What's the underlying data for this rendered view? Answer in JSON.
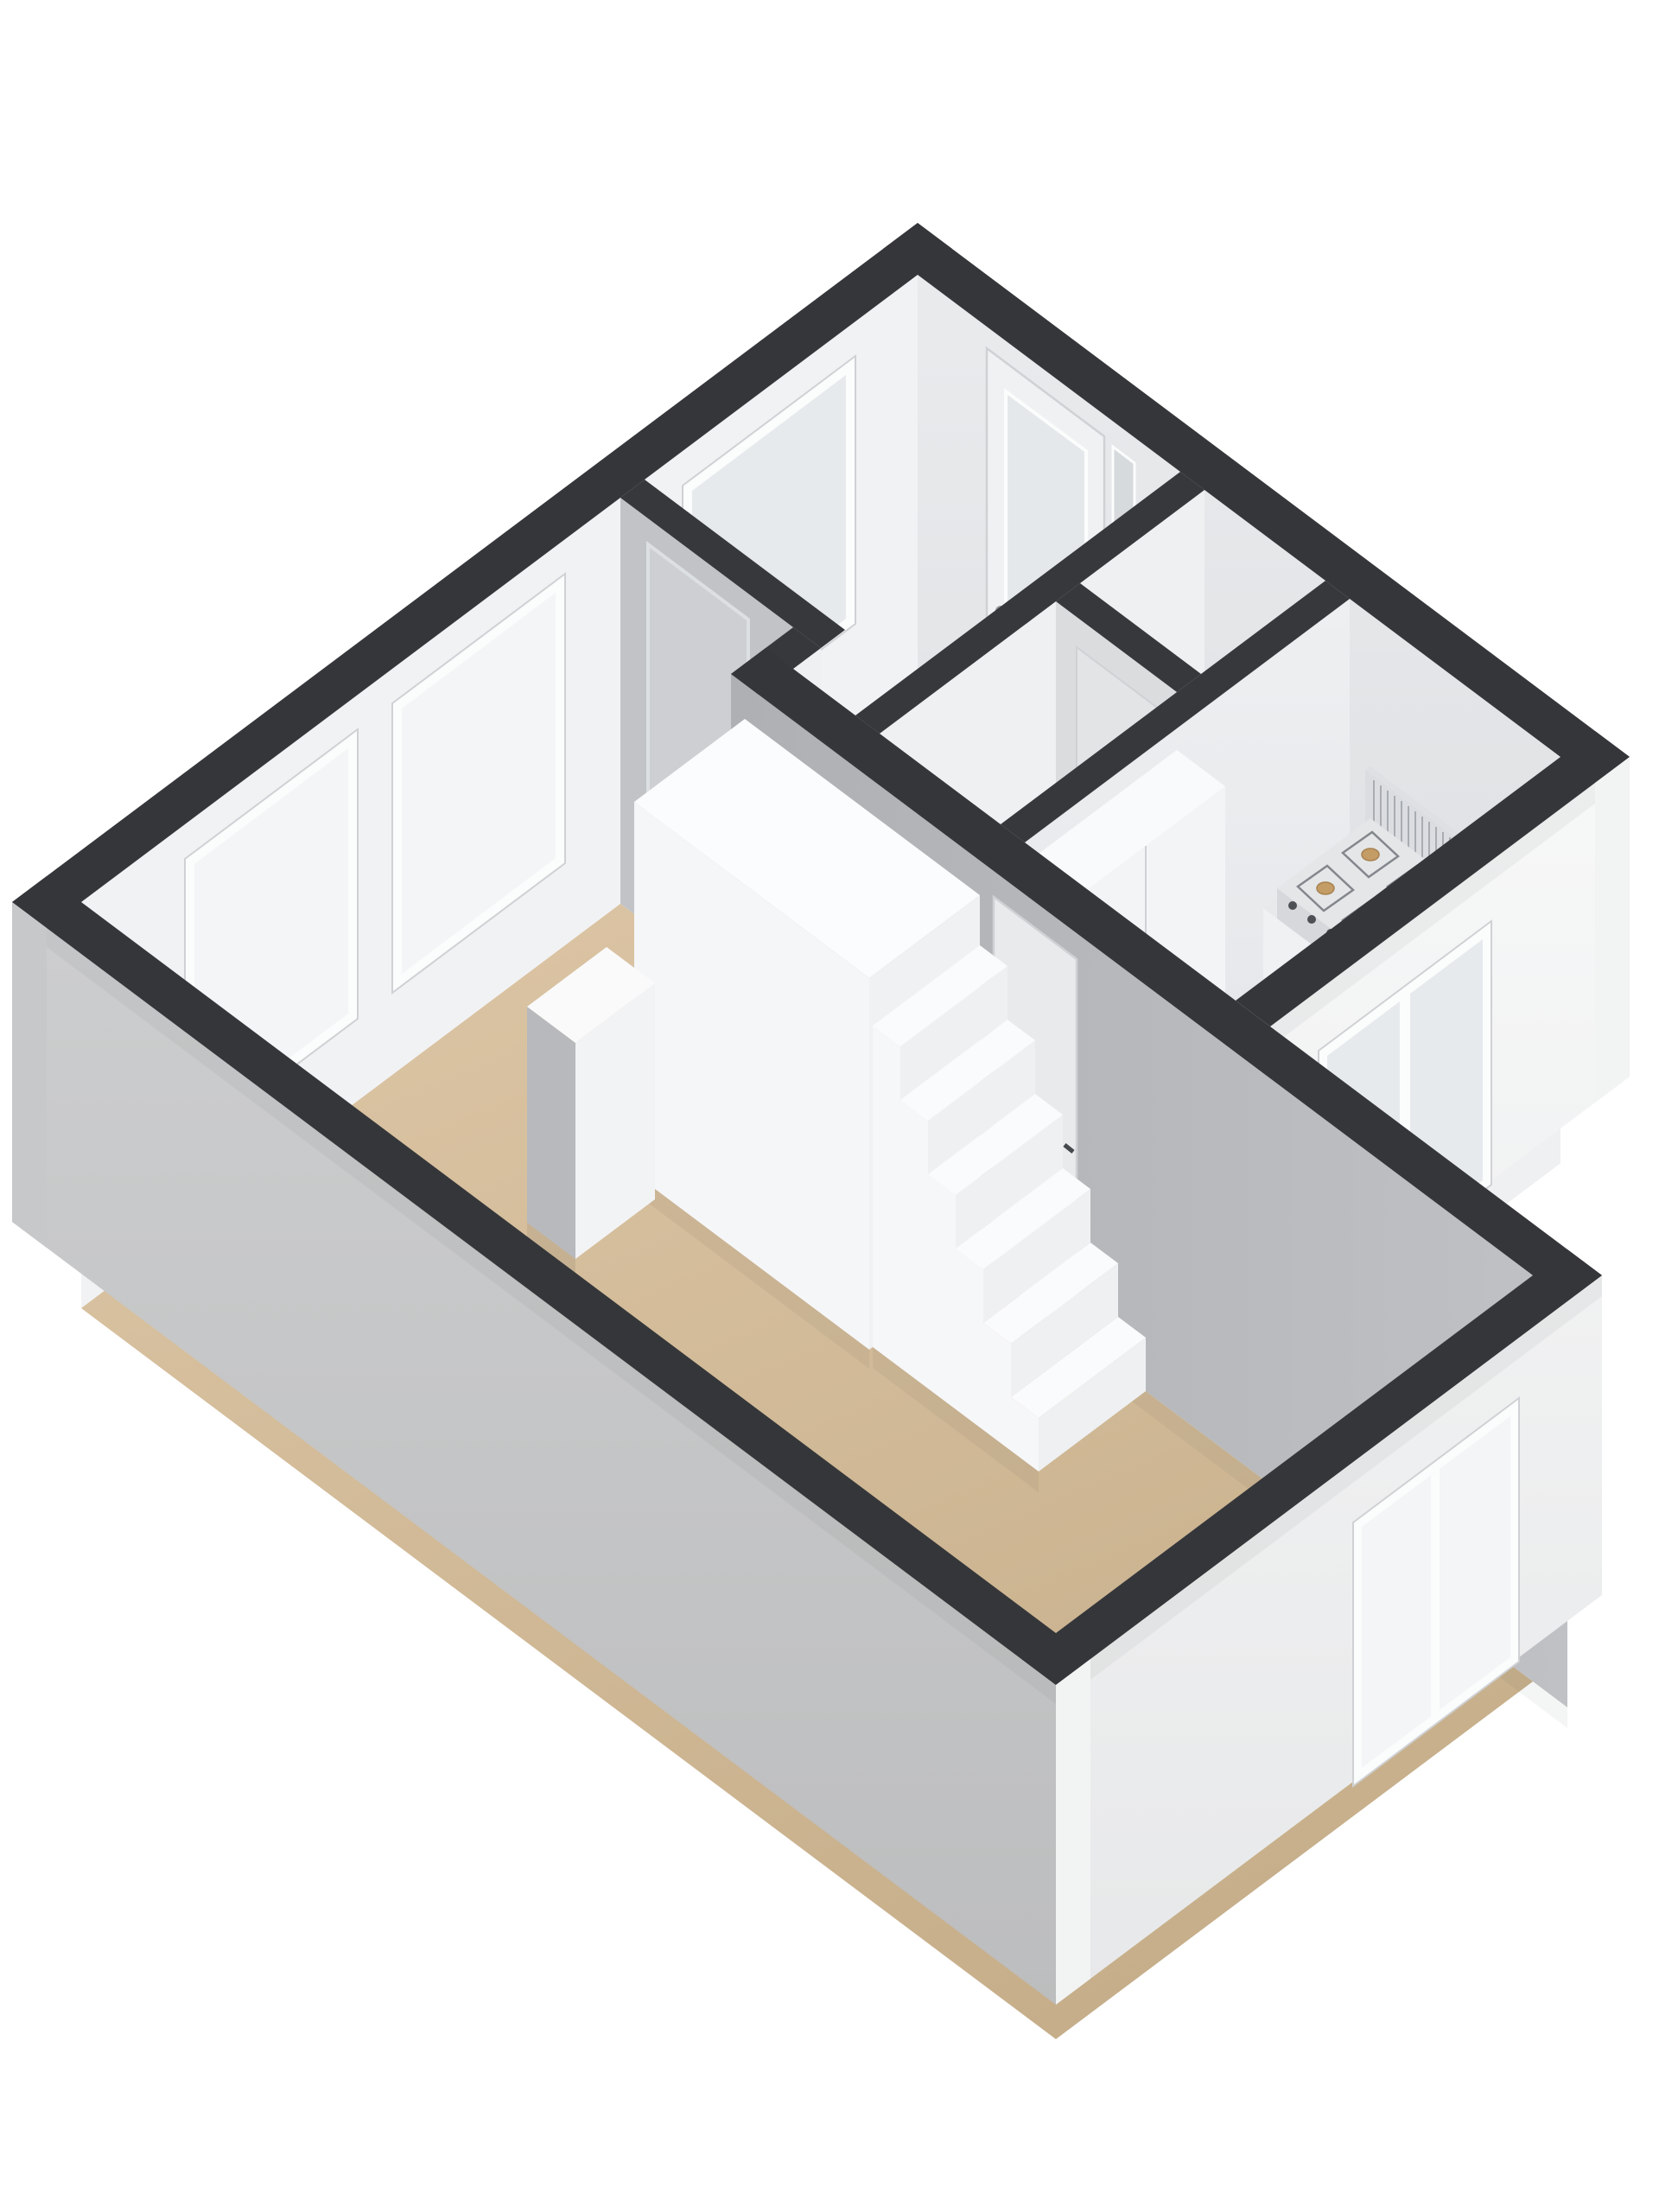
{
  "scene": {
    "kind": "floorplan-3d-isometric",
    "rooms": [
      "hall",
      "closet-a",
      "closet-b",
      "kitchen",
      "living-room"
    ],
    "fixtures": [
      "front-door",
      "hall-window",
      "living-room-window-1",
      "living-room-window-2",
      "kitchen-window",
      "living-room-east-window",
      "living-room-door",
      "kitchen-door",
      "closet-door",
      "staircase",
      "stair-landing-box",
      "kitchen-counter",
      "gas-stove",
      "sink",
      "tall-cabinet",
      "pillar"
    ]
  },
  "colors": {
    "bg": "#ffffff",
    "cap": "#34363a",
    "cap_inner": "#36383c",
    "ext_white_top": "#f7f8f8",
    "ext_white_bottom": "#e7e8e9",
    "ext_white_flat": "#f2f3f3",
    "ext_gray_top": "#cdcecf",
    "ext_gray_bottom": "#bcbdbe",
    "ext_gray_flat": "#c7c8ca",
    "w1_top": "#e9ebed",
    "w1_bottom": "#dcdee1",
    "w2_face": "#f1f2f4",
    "w6_face": "#c1c3c6",
    "w4_left": "#aeb0b4",
    "w4_right": "#bfc1c4",
    "w7_face": "#eef0f1",
    "w8_face": "#dadcde",
    "w9_top": "#edeff1",
    "w9_bottom": "#e2e4e7",
    "stub_face": "#eef0f2",
    "hall_floor": "#d4d5d7",
    "corridor_floor": "#d1d2d4",
    "closet_a_floor": "#d0d1d3",
    "closet_b_floor": "#d3d4d6",
    "kitchen_floor_near": "#cdd2d9",
    "kitchen_floor_far": "#b7bec9",
    "lr_floor_top": "#dac3a2",
    "lr_floor_bottom": "#c6ae8a",
    "glass": "#f3f5f7",
    "glass_dim": "#e7eaed",
    "glass_dark": "#d6dadd",
    "frame_white": "#fbfcfc",
    "frame_line": "#cfd1d4",
    "door_front": "#f0f1f2",
    "door_glass": "#e5e8ea",
    "lr_door": "#cdcfd2",
    "lr_door_frame": "#dde0e2",
    "k_door": "#e8eaec",
    "w8_door": "#e2e4e6",
    "stair_tread": "#fafbfc",
    "stair_riser": "#eef0f2",
    "stair_side": "#f6f7f9",
    "box_top": "#fbfcfd",
    "box_x": "#eff1f3",
    "box_y": "#f5f6f8",
    "pillar_top": "#fafafb",
    "pillar_x": "#f2f3f4",
    "pillar_y": "#b7b9bc",
    "counter_top": "#e7e9eb",
    "counter_front": "#f0f1f3",
    "counter_end": "#eef0f1",
    "cabinet_top": "#f9fafb",
    "cabinet_front": "#f3f4f6",
    "cabinet_side": "#e5e7e9",
    "stove_top": "#e4e6e8",
    "stove_front": "#d6d8db",
    "stove_side": "#dee0e3",
    "stove_back": "#dbdde0",
    "vent_line": "#a9adb2",
    "grate": "#83878c",
    "burner": "#c49c66",
    "burner_dark": "#a8824f",
    "knob": "#4d5055",
    "sink_rim": "#d5d8da",
    "sink_basin": "#c3c7ca",
    "sink_deep": "#b4b9bd",
    "chrome": "#94999e",
    "handle_dark": "#45484c",
    "shadow": "#2f3236"
  }
}
